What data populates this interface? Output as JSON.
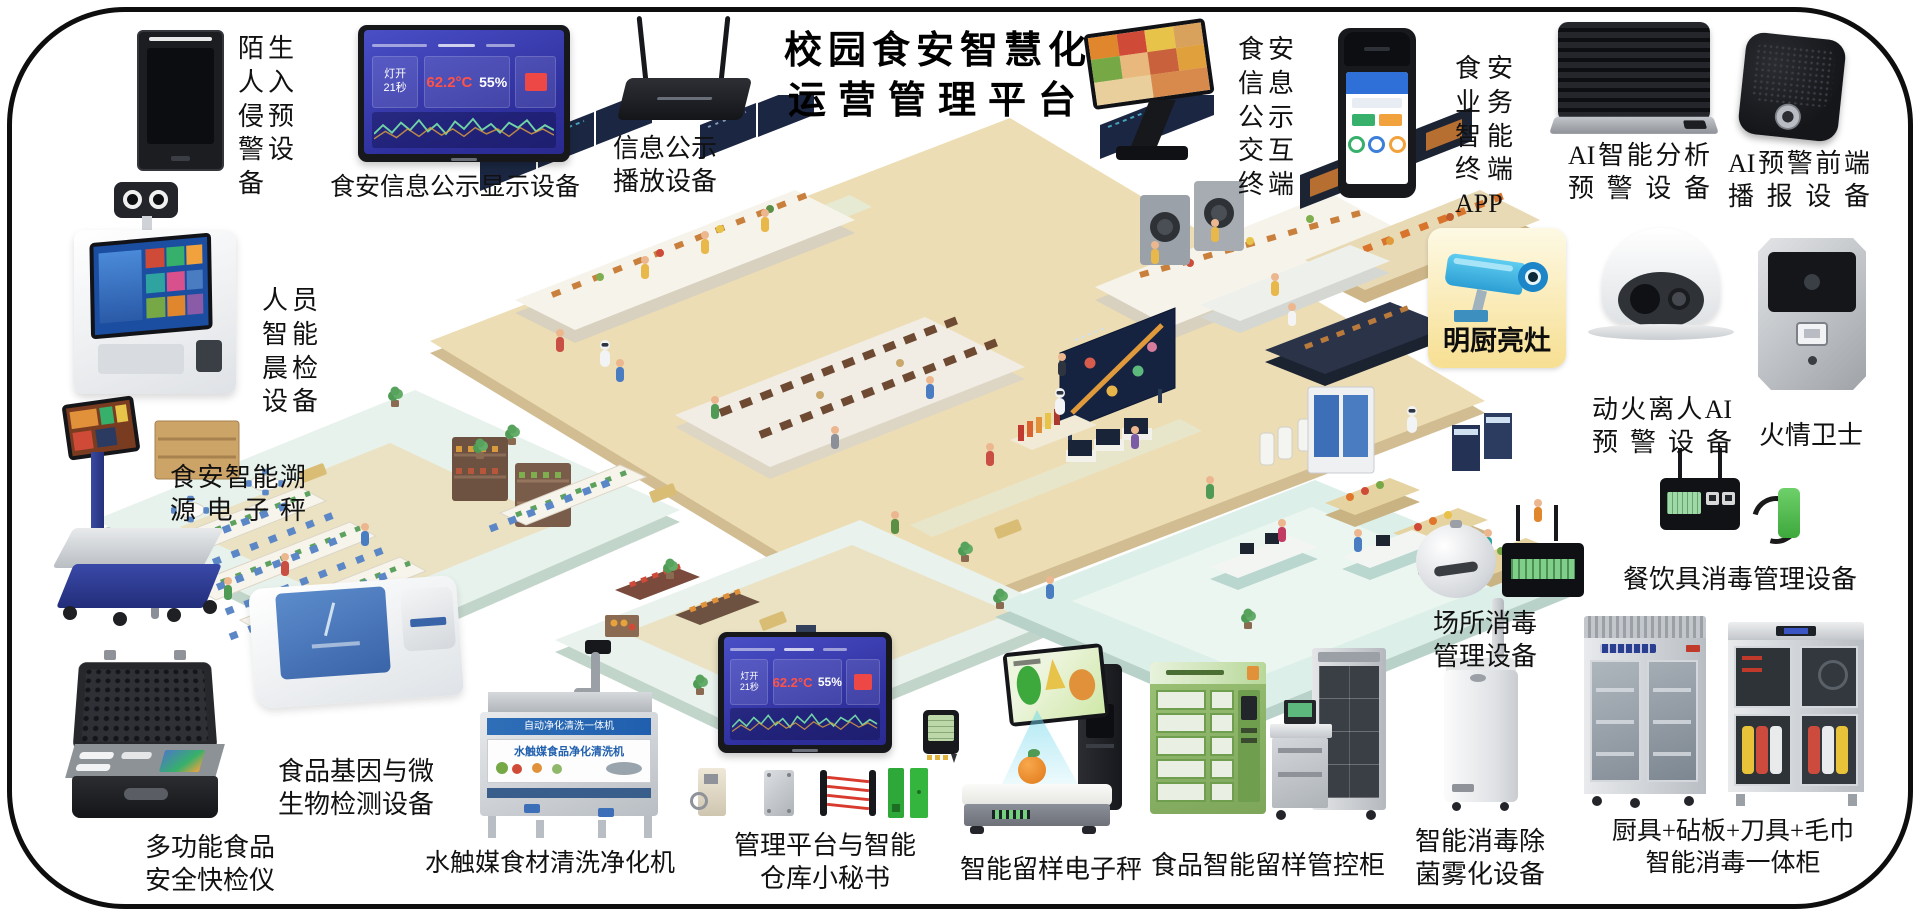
{
  "title": {
    "line1": "校园食安智慧化",
    "line2": "运营管理平台"
  },
  "dashboard": {
    "status_top": "灯开",
    "status_bottom": "21秒",
    "temperature": "62.2°C",
    "humidity": "55%"
  },
  "badge": {
    "label": "明厨亮灶"
  },
  "wash_banner": {
    "line1": "自动净化清洗一体机",
    "line2": "水触媒食品净化清洗机"
  },
  "devices": {
    "stranger": "陌生人入侵预警设备",
    "display": "食安信息公示显示设备",
    "broadcast": "信息公示播放设备",
    "kiosk": "食安信息公示交互终端",
    "pos_app": "食安业务智能终端APP",
    "ai_analysis": "AI智能分析预警设备",
    "ai_speaker": "AI预警前端播报设备",
    "fire_ai": "动火离人AI预警设备",
    "fire_guard": "火情卫士",
    "tableware": "餐饮具消毒管理设备",
    "morning_check": "人员智能晨检设备",
    "trace_scale": "食安智能溯源电子秤",
    "quick_test": "多功能食品安全快检仪",
    "gene_test": "食品基因与微生物检测设备",
    "wash_machine": "水触媒食材清洗净化机",
    "mgmt_platform": "管理平台与智能仓库小秘书",
    "sample_scale": "智能留样电子秤",
    "sample_cabinet": "食品智能留样管控柜",
    "venue_disinfect": "场所消毒管理设备",
    "fog_device": "智能消毒除菌雾化设备",
    "kitchen_cabinet": "厨具+砧板+刀具+毛巾智能消毒一体柜"
  }
}
